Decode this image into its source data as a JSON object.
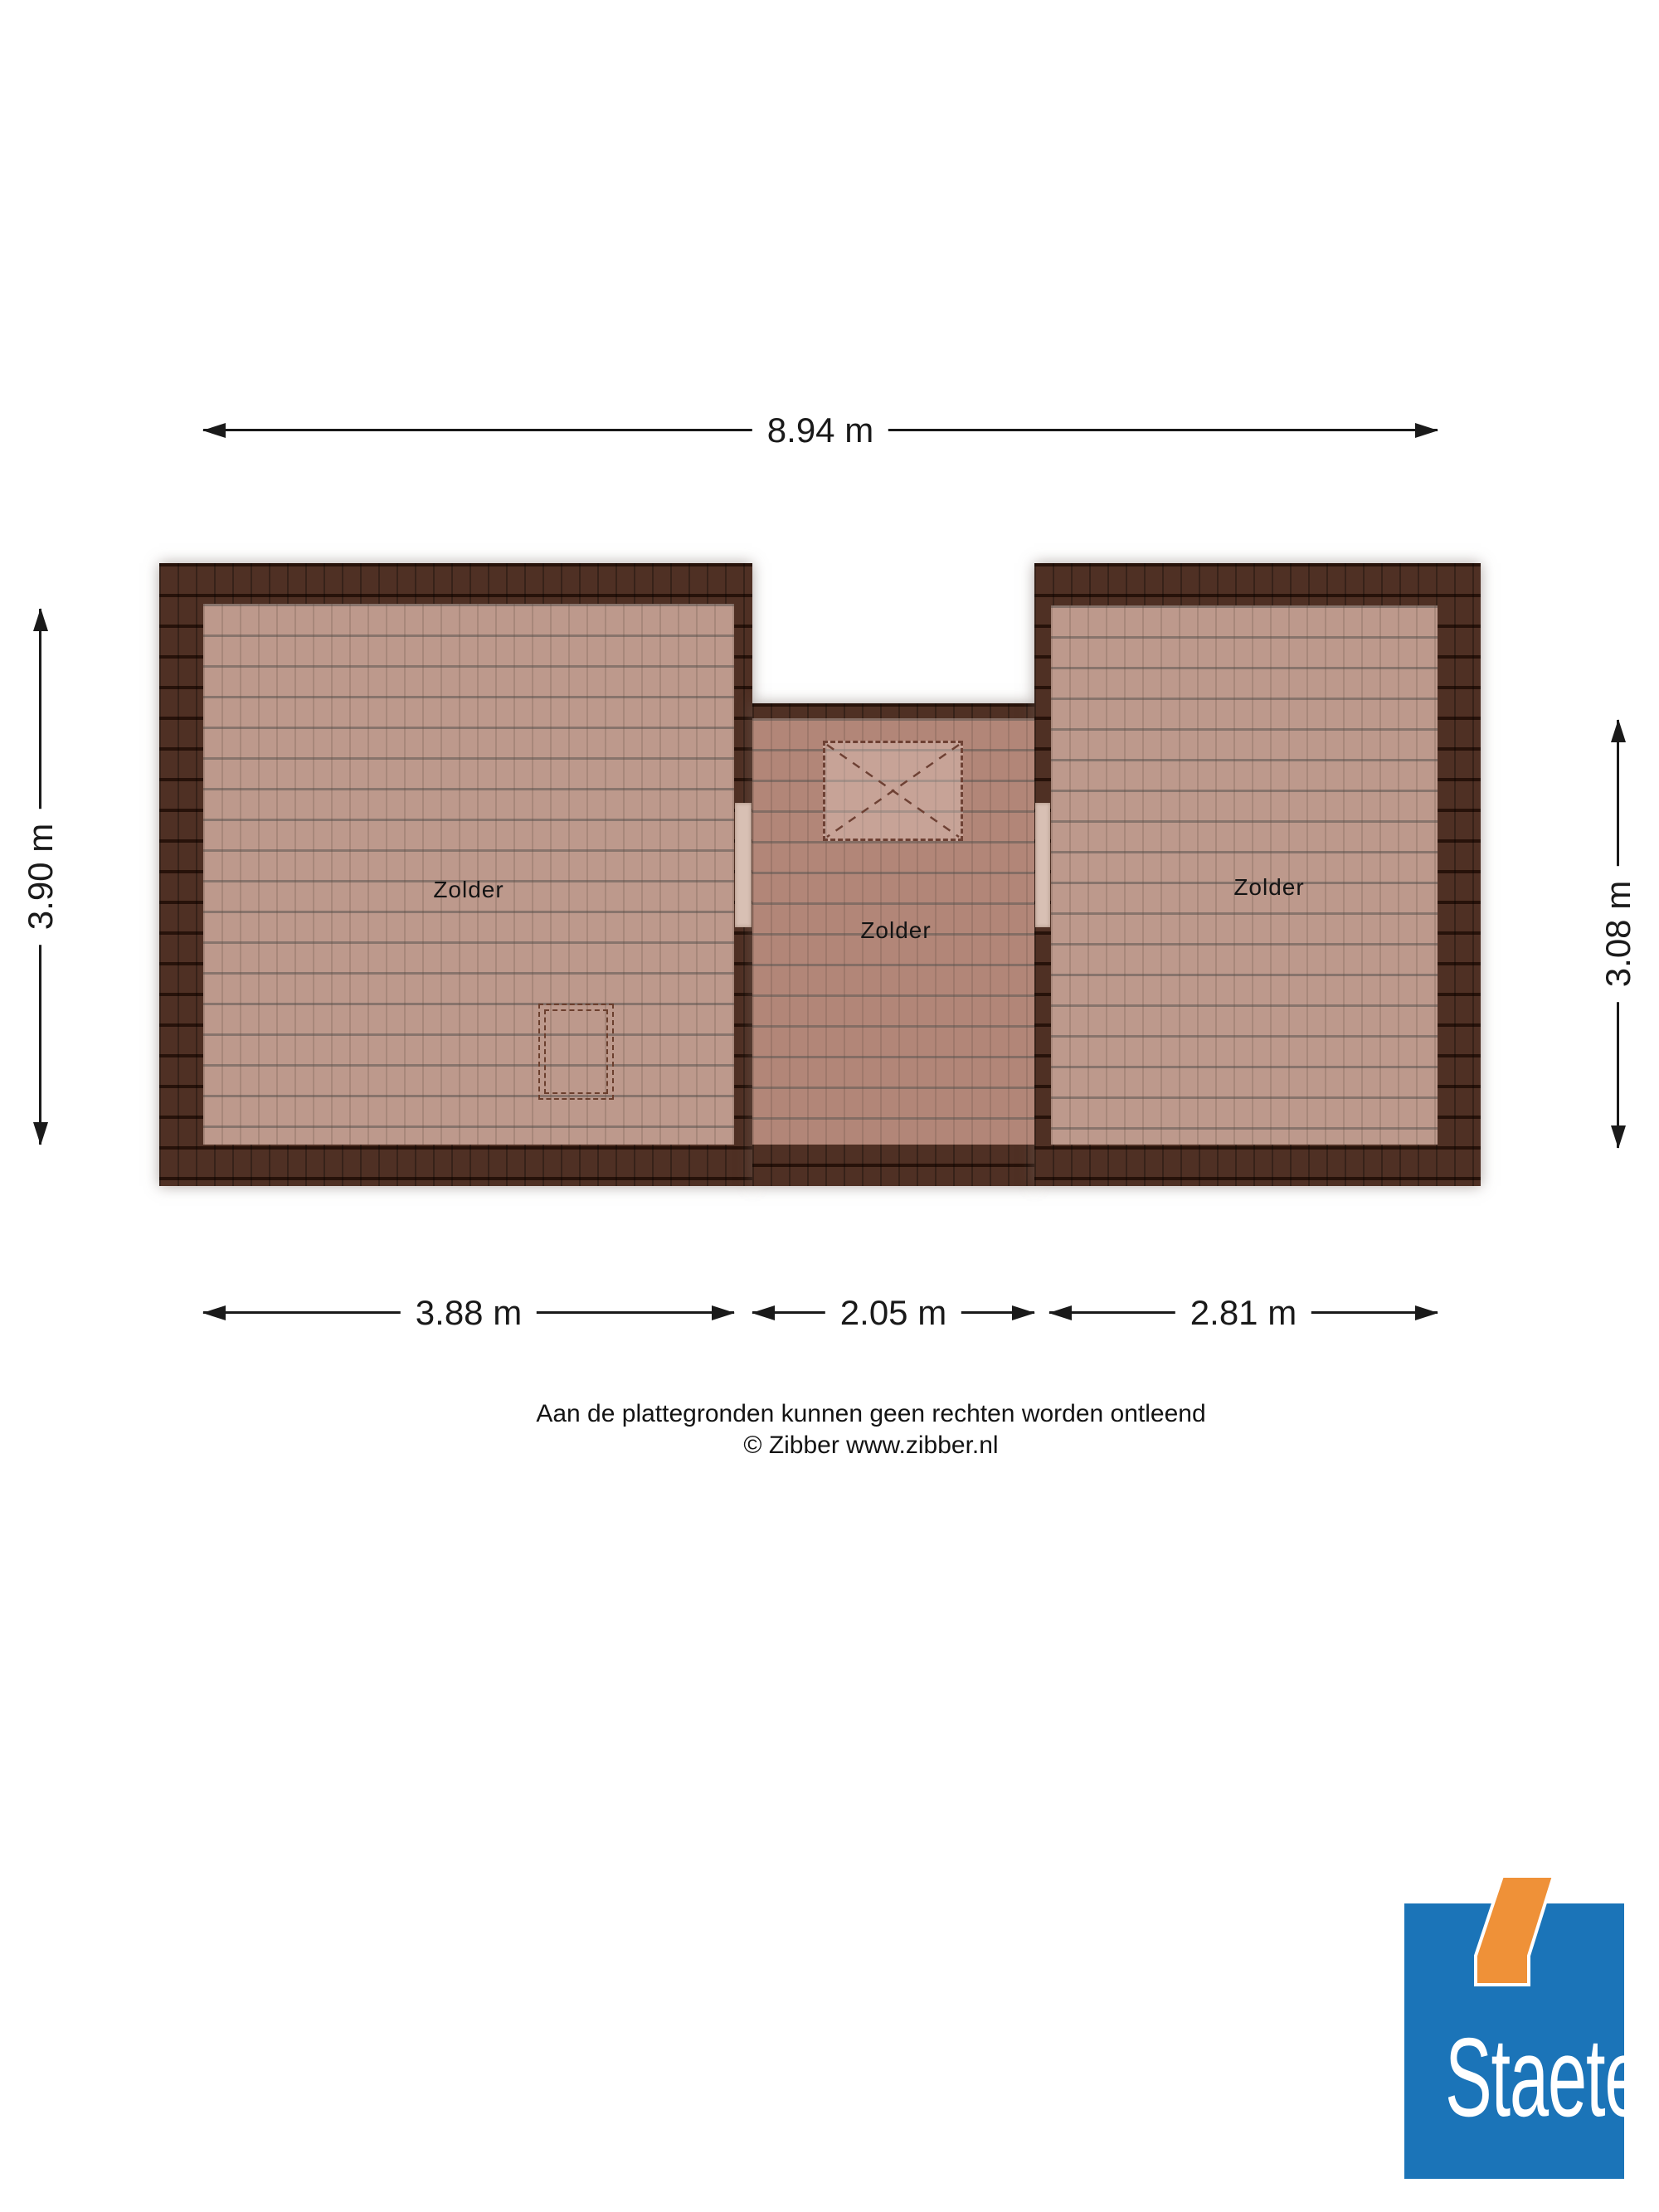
{
  "floorplan": {
    "rooms": [
      {
        "label": "Zolder"
      },
      {
        "label": "Zolder"
      },
      {
        "label": "Zolder"
      }
    ],
    "dimensions": {
      "top": "8.94 m",
      "left": "3.90 m",
      "right": "3.08 m",
      "bottom_left": "3.88 m",
      "bottom_middle": "2.05 m",
      "bottom_right": "2.81 m"
    }
  },
  "footer": {
    "disclaimer": "Aan de plattegronden kunnen geen rechten worden ontleend",
    "copyright": "© Zibber www.zibber.nl"
  },
  "logo": {
    "text": "Staete"
  },
  "colors": {
    "roof_dark": "#4f3024",
    "roof_line": "#27120a",
    "floor_light": "#bd998c",
    "floor_mid": "#b28678",
    "floor_line": "#8a7d77",
    "wall_door": "#d8c0b4",
    "dim": "#1a1a1a",
    "logo_blue": "#1b74b8",
    "logo_orange": "#ef9138"
  }
}
